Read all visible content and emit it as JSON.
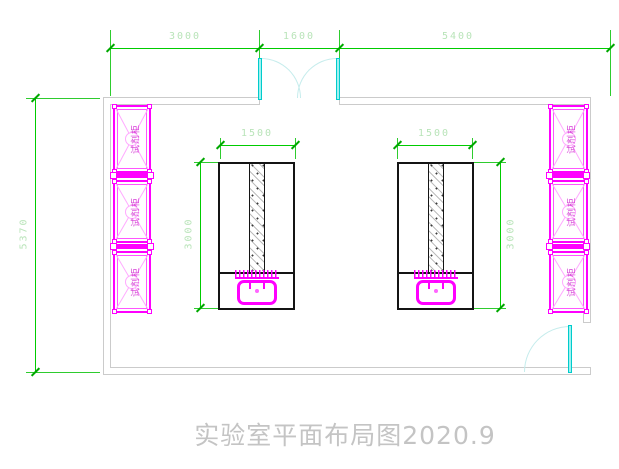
{
  "drawing_title": "实验室平面布局图2020.9",
  "dimensions": {
    "top_segment_1": "3000",
    "top_segment_2": "1600",
    "top_segment_3": "5400",
    "room_height": "5370",
    "bench_left_width": "1500",
    "bench_left_depth": "3000",
    "bench_right_width": "1500",
    "bench_right_depth": "3000"
  },
  "cabinets": {
    "left": [
      {
        "label": "试剂柜"
      },
      {
        "label": "试剂柜"
      },
      {
        "label": "试剂柜"
      }
    ],
    "right": [
      {
        "label": "试剂柜"
      },
      {
        "label": "试剂柜"
      },
      {
        "label": "试剂柜"
      }
    ]
  },
  "icons": {
    "double_door": "double-swing-door-icon",
    "single_door": "single-swing-door-icon",
    "sink": "sink-fixture-icon"
  },
  "colors": {
    "dimension_line": "#00cc00",
    "dimension_text": "#b9e4b9",
    "wall": "#cbcbcb",
    "door_leaf": "#9ff0f0",
    "door_arc": "#c5ecec",
    "cabinet_outline": "#ff00ff",
    "cabinet_hatch": "#ffaaff",
    "cabinet_text": "#d63fd6",
    "bench_outline": "#141414",
    "fixture": "#ff00ff",
    "title_text": "#c4c4c4"
  }
}
